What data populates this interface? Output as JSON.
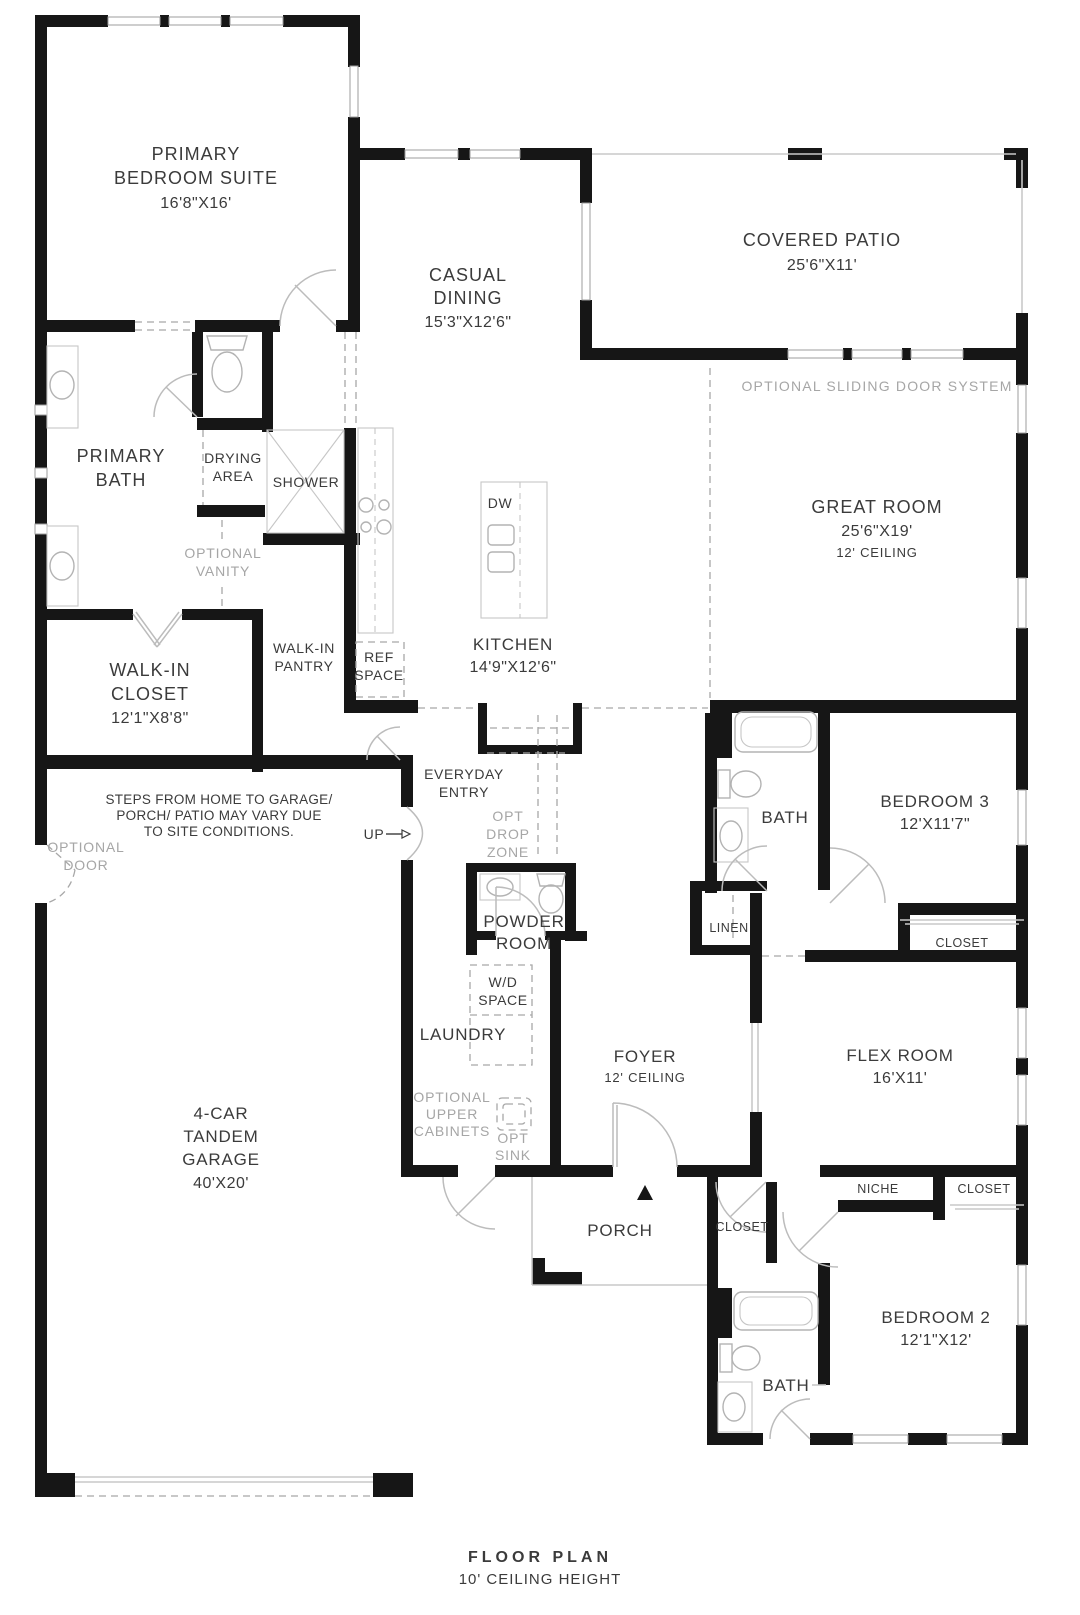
{
  "colors": {
    "wall": "#161616",
    "text": "#3b3b3b",
    "muted_text": "#a6a6a6",
    "fixture_line": "#b3b3b3",
    "background": "#ffffff"
  },
  "footer": {
    "title": "FLOOR PLAN",
    "subtitle": "10' CEILING HEIGHT"
  },
  "rooms": {
    "primary_bedroom_suite": {
      "line1": "PRIMARY",
      "line2": "BEDROOM SUITE",
      "dims": "16'8\"X16'"
    },
    "casual_dining": {
      "line1": "CASUAL",
      "line2": "DINING",
      "dims": "15'3\"X12'6\""
    },
    "covered_patio": {
      "line1": "COVERED PATIO",
      "dims": "25'6\"X11'"
    },
    "great_room": {
      "line1": "GREAT ROOM",
      "dims": "25'6\"X19'",
      "ceiling": "12' CEILING"
    },
    "primary_bath": {
      "line1": "PRIMARY",
      "line2": "BATH"
    },
    "drying_area": {
      "line1": "DRYING",
      "line2": "AREA"
    },
    "shower": {
      "line1": "SHOWER"
    },
    "walk_in_closet": {
      "line1": "WALK-IN",
      "line2": "CLOSET",
      "dims": "12'1\"X8'8\""
    },
    "walk_in_pantry": {
      "line1": "WALK-IN",
      "line2": "PANTRY"
    },
    "ref_space": {
      "line1": "REF",
      "line2": "SPACE"
    },
    "kitchen": {
      "line1": "KITCHEN",
      "dims": "14'9\"X12'6\""
    },
    "everyday_entry": {
      "line1": "EVERYDAY",
      "line2": "ENTRY"
    },
    "powder_room": {
      "line1": "POWDER",
      "line2": "ROOM"
    },
    "laundry": {
      "line1": "LAUNDRY"
    },
    "wd_space": {
      "line1": "W/D",
      "line2": "SPACE"
    },
    "foyer": {
      "line1": "FOYER",
      "ceiling": "12' CEILING"
    },
    "bath_bed3": {
      "line1": "BATH"
    },
    "bedroom_3": {
      "line1": "BEDROOM 3",
      "dims": "12'X11'7\""
    },
    "linen": {
      "line1": "LINEN"
    },
    "closet_bed3": {
      "line1": "CLOSET"
    },
    "flex_room": {
      "line1": "FLEX ROOM",
      "dims": "16'X11'"
    },
    "niche": {
      "line1": "NICHE"
    },
    "closet_bed2": {
      "line1": "CLOSET"
    },
    "porch": {
      "line1": "PORCH"
    },
    "closet_entry": {
      "line1": "CLOSET"
    },
    "garage": {
      "line1": "4-CAR",
      "line2": "TANDEM",
      "line3": "GARAGE",
      "dims": "40'X20'"
    },
    "bath_bed2": {
      "line1": "BATH"
    },
    "bedroom_2": {
      "line1": "BEDROOM 2",
      "dims": "12'1\"X12'"
    }
  },
  "annotations": {
    "sliding_door": "OPTIONAL SLIDING DOOR SYSTEM",
    "optional_vanity": {
      "line1": "OPTIONAL",
      "line2": "VANITY"
    },
    "steps_note": {
      "line1": "STEPS FROM HOME TO GARAGE/",
      "line2": "PORCH/ PATIO MAY VARY DUE",
      "line3": "TO SITE CONDITIONS."
    },
    "optional_door": {
      "line1": "OPTIONAL",
      "line2": "DOOR"
    },
    "opt_drop_zone": {
      "line1": "OPT",
      "line2": "DROP",
      "line3": "ZONE"
    },
    "optional_upper_cabinets": {
      "line1": "OPTIONAL",
      "line2": "UPPER",
      "line3": "CABINETS"
    },
    "opt_sink": {
      "line1": "OPT",
      "line2": "SINK"
    },
    "up": "UP",
    "dw": "DW"
  }
}
